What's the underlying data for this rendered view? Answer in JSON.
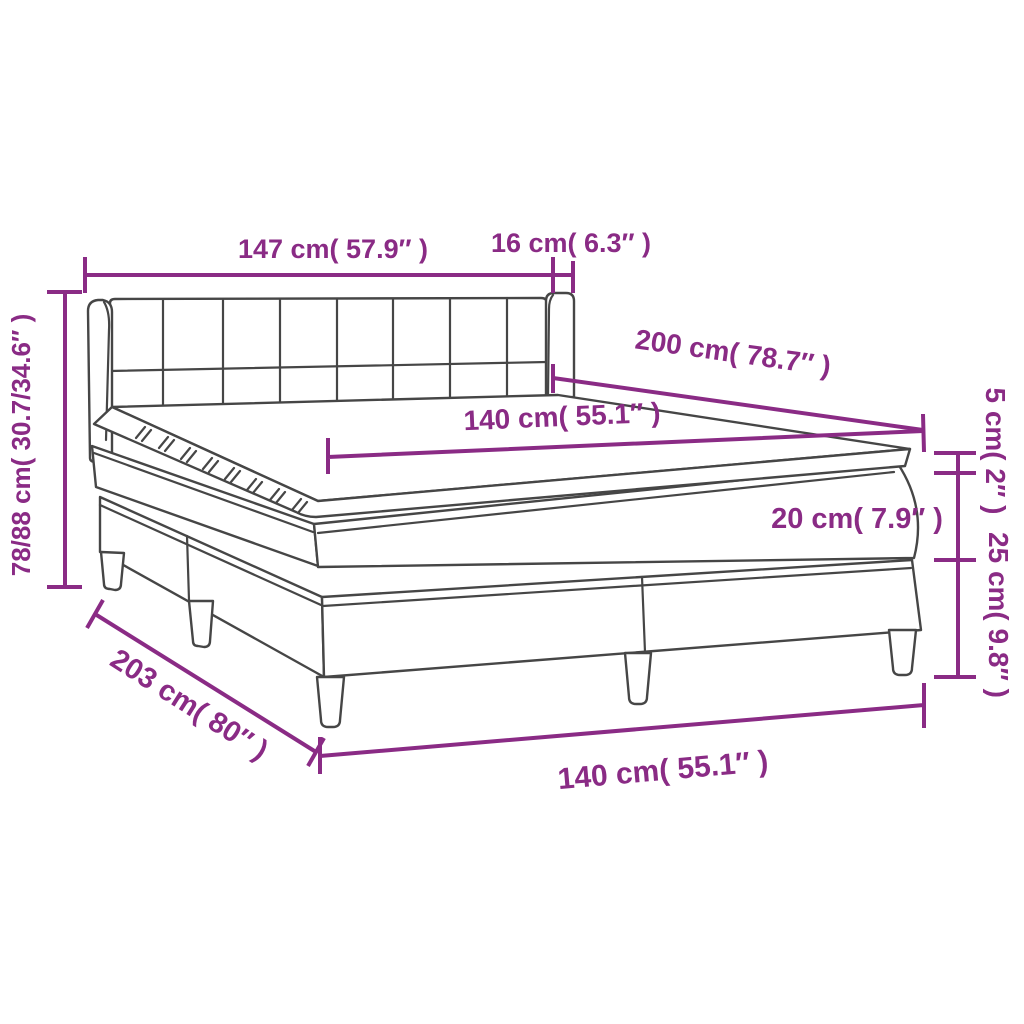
{
  "diagram": {
    "kind": "product-dimension-diagram",
    "subject": "box spring bed with mattress and topper",
    "accent_color": "#8A2B85",
    "line_color": "#464646",
    "background_color": "#ffffff",
    "labels": {
      "headboard_width": "147 cm( 57.9″ )",
      "side_wing_depth": "16 cm( 6.3″ )",
      "overall_height": "78/88 cm( 30.7/34.6″ )",
      "length_top": "200 cm( 78.7″ )",
      "width_top": "140 cm( 55.1″ )",
      "topper_height": "5 cm( 2″ )",
      "mattress_height": "20 cm( 7.9″ )",
      "base_height": "25 cm( 9.8″ )",
      "length_base": "203 cm( 80″ )",
      "width_base": "140 cm( 55.1″ )"
    }
  }
}
